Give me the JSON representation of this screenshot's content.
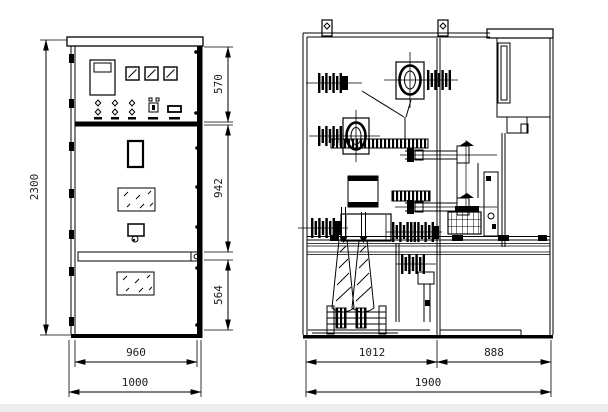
{
  "drawing": {
    "background": "#ffffff",
    "line_color": "#000000",
    "front_view": {
      "dims": {
        "total_height": "2300",
        "instrument_panel_height": "570",
        "mid_section_height": "942",
        "lower_section_height": "564",
        "inner_width": "960",
        "total_width": "1000"
      }
    },
    "side_view": {
      "dims": {
        "front_depth": "1012",
        "rear_depth": "888",
        "total_depth": "1900"
      }
    }
  }
}
